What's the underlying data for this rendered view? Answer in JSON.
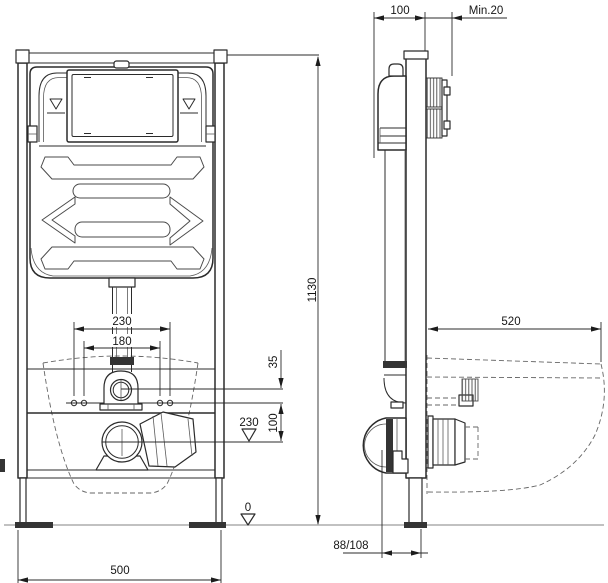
{
  "drawing": {
    "kind": "wc-installation-frame-technical-drawing",
    "views": [
      "front",
      "side"
    ]
  },
  "dims": {
    "frame_depth": "100",
    "wall_clearance_min": "Min.20",
    "frame_height": "1130",
    "bowl_projection": "520",
    "fixing_spacing_outer": "230",
    "fixing_spacing_inner": "180",
    "flush_bend_offset": "35",
    "fixing_to_drain": "100",
    "drain_height_level": "230",
    "floor_level": "0",
    "frame_width": "500",
    "drain_wall_distance": "88/108"
  },
  "colors": {
    "line": "#2b2b2b",
    "hidden_line": "#666666",
    "background": "#ffffff"
  }
}
